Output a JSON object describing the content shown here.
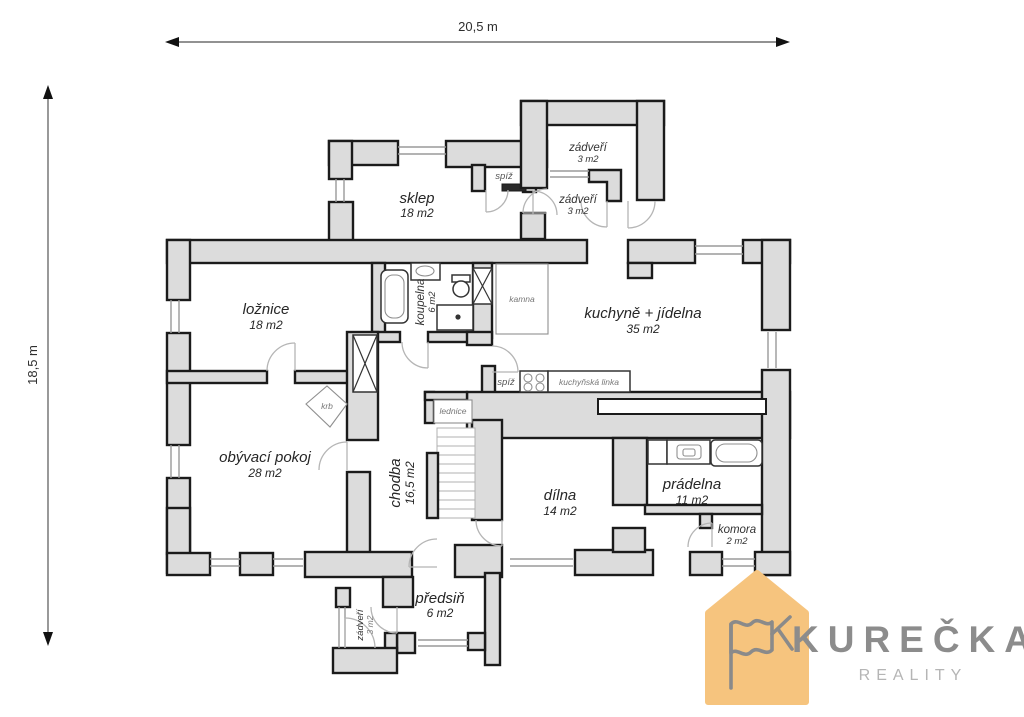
{
  "dimensions": {
    "width_label": "20,5 m",
    "height_label": "18,5 m"
  },
  "rooms": {
    "sklep": {
      "name": "sklep",
      "area": "18 m2"
    },
    "spiz_horni": {
      "name": "spíž"
    },
    "zadveri_horni": {
      "name": "zádveří",
      "area": "3 m2"
    },
    "zadveri_stredni": {
      "name": "zádveří",
      "area": "3 m2"
    },
    "loznice": {
      "name": "ložnice",
      "area": "18 m2"
    },
    "koupelna": {
      "name": "koupelna",
      "area": "6 m2"
    },
    "kamna": {
      "name": "kamna"
    },
    "kuchyne": {
      "name": "kuchyně + jídelna",
      "area": "35 m2"
    },
    "spiz_dolni": {
      "name": "spíž"
    },
    "kuchynska_linka": {
      "name": "kuchyňská linka"
    },
    "lednice": {
      "name": "lednice"
    },
    "krb": {
      "name": "krb"
    },
    "obyvaci": {
      "name": "obývací pokoj",
      "area": "28 m2"
    },
    "chodba": {
      "name": "chodba",
      "area": "16,5 m2"
    },
    "dilna": {
      "name": "dílna",
      "area": "14 m2"
    },
    "pradelna": {
      "name": "prádelna",
      "area": "11 m2"
    },
    "komora": {
      "name": "komora",
      "area": "2 m2"
    },
    "predsin": {
      "name": "předsiň",
      "area": "6 m2"
    },
    "zadveri_dolni": {
      "name": "zádveří",
      "area": "3 m2"
    }
  },
  "logo": {
    "brand": "KUREČKA",
    "subtitle": "REALITY",
    "house_color": "#f6c47e",
    "brand_color": "#8c8c8c",
    "subtitle_color": "#b5b5b5"
  },
  "colors": {
    "wall_fill": "#dcdcdc",
    "wall_stroke": "#1b1b1b"
  }
}
